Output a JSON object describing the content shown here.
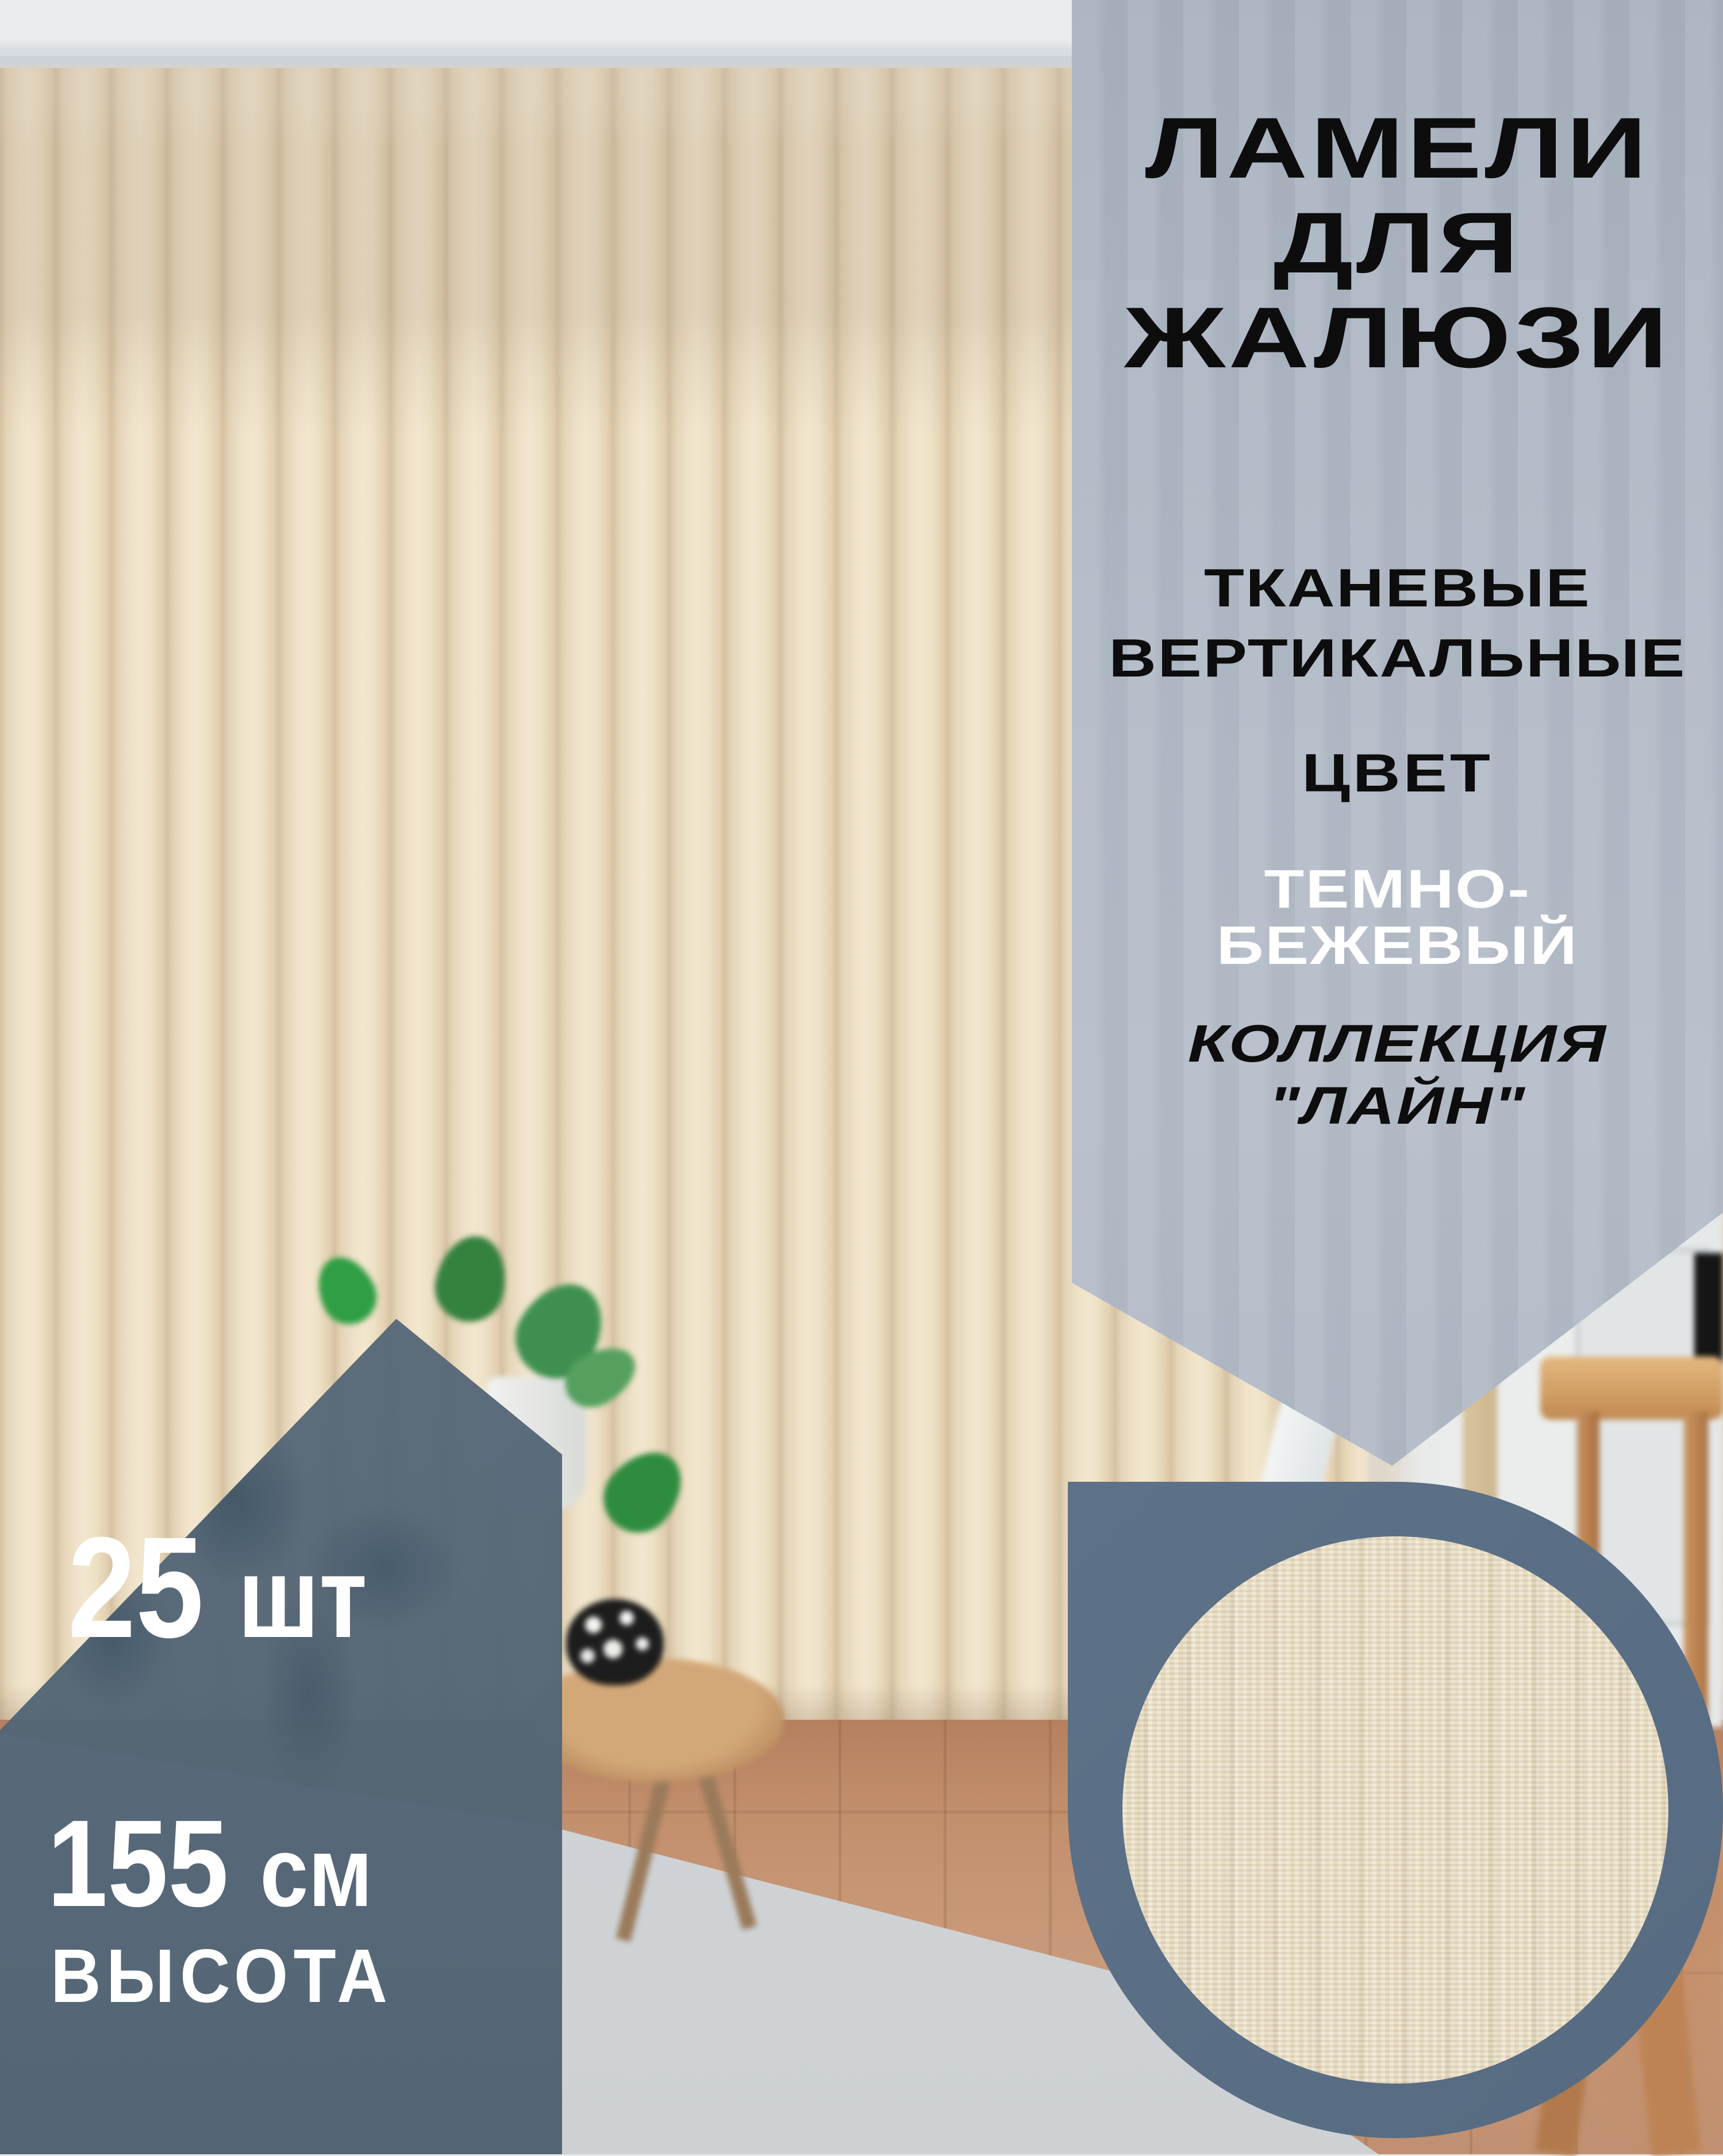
{
  "product_card": {
    "title_lines": [
      "ЛАМЕЛИ",
      "ДЛЯ",
      "ЖАЛЮЗИ"
    ],
    "subtitle_lines": [
      "ТКАНЕВЫЕ",
      "ВЕРТИКАЛЬНЫЕ"
    ],
    "color_label": "ЦВЕТ",
    "color_value_lines": [
      "ТЕМНО-",
      "БЕЖЕВЫЙ"
    ],
    "collection_lines": [
      "КОЛЛЕКЦИЯ",
      "\"ЛАЙН\""
    ],
    "badge": {
      "quantity": "25",
      "quantity_unit": "шт",
      "height_value": "155",
      "height_unit": "см",
      "height_label": "ВЫСОТА"
    },
    "colors": {
      "panel_background": "#aeb7c3",
      "badge_background": "#566878",
      "swatch_ring": "#5a7086",
      "swatch_fabric": "#e9ddc1",
      "title_text": "#0d0d0d",
      "color_value_text": "#ffffff",
      "badge_text": "#ffffff",
      "blinds_beige": "#eee1c6",
      "floor_wood": "#c3906e",
      "rug_gray": "#d9dcde"
    },
    "scene": "beige vertical fabric blinds in living room with wooden floor, plant, side table with bowl, dining chair"
  }
}
